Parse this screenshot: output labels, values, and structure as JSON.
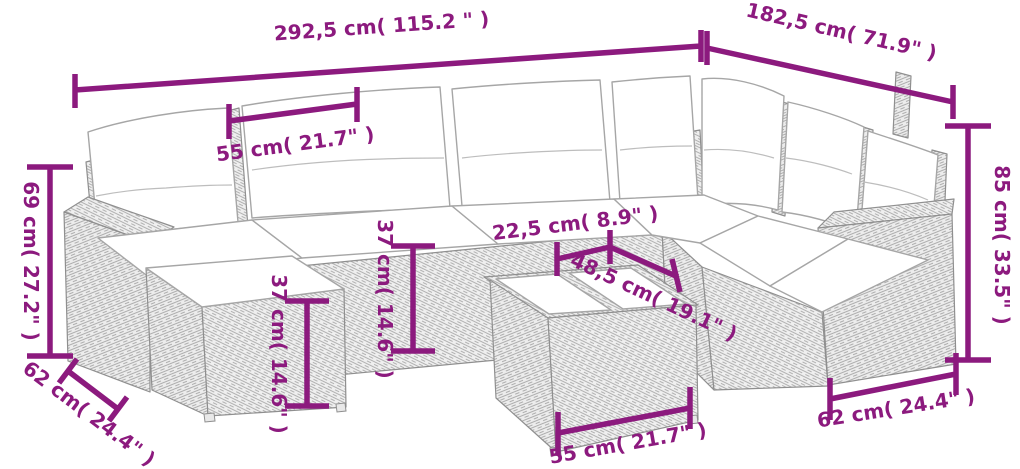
{
  "title": "Rattan corner sofa set dimension diagram",
  "colors": {
    "dimension": "#8c1a7e",
    "line-art": "#9a9a9a",
    "wicker": "#ededed",
    "cushion": "#ffffff",
    "background": "#ffffff"
  },
  "dimensions": {
    "overall_width": "292,5 cm( 115.2 \" )",
    "overall_depth": "182,5 cm( 71.9\" )",
    "backrest_width": "55 cm( 21.7\" )",
    "armrest_height": "69 cm( 27.2\" )",
    "seat_height": "37 cm( 14.6\" )",
    "ottoman_height": "37 cm( 14.6\" )",
    "tabletop_half_width": "22,5 cm( 8.9\" )",
    "tabletop_length": "48,5 cm( 19.1\" )",
    "overall_height": "85 cm( 33.5\" )",
    "ottoman_depth": "62 cm( 24.4\" )",
    "table_width": "55 cm( 21.7\" )",
    "armrest_depth": "62 cm( 24.4\" )"
  }
}
